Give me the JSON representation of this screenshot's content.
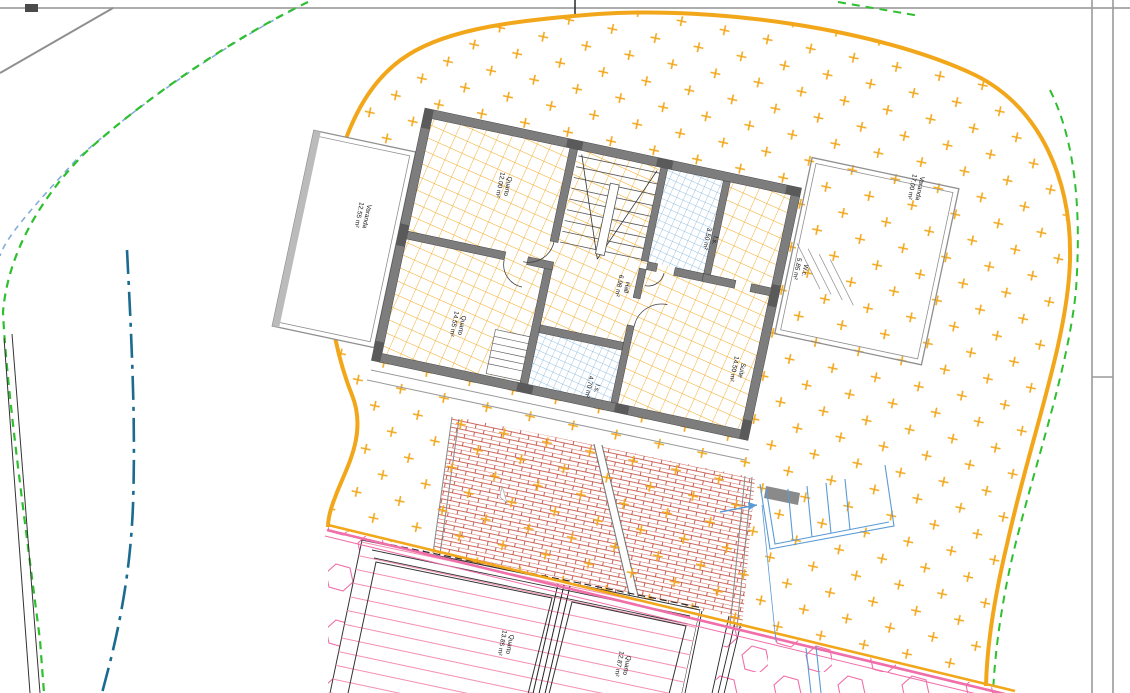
{
  "plan": {
    "type": "architectural-site-and-floor-plan",
    "labels": {
      "varanda_left": {
        "name": "Varanda",
        "area": "12.55 m²"
      },
      "quarto_top_left": {
        "name": "Quarto",
        "area": "12.00 m²"
      },
      "quarto_bottom_left": {
        "name": "Quarto",
        "area": "14.55 m²"
      },
      "hall": {
        "name": "Hall",
        "area": "6.98 m²"
      },
      "is_top": {
        "name": "I.s.",
        "area": "3.50 m²"
      },
      "wc": {
        "name": "W.c.",
        "area": "5.85 m²"
      },
      "suite": {
        "name": "Suíte",
        "area": "14.50 m²"
      },
      "is_bottom": {
        "name": "I.s.",
        "area": "4.70 m²"
      },
      "varanda_right": {
        "name": "Varanda",
        "area": "17.00 m²"
      },
      "quarto_lower_left": {
        "name": "Quarto",
        "area": "13.85 m²"
      },
      "quarto_lower_right": {
        "name": "Quarto",
        "area": "12.87 m²"
      }
    },
    "colors": {
      "lot_boundary": "#F2A71B",
      "terrain_hatch": "#F2A71B",
      "floor_tile": "#F2A71B",
      "bath_tile": "#74AEDC",
      "wall_fill": "#7D7D7D",
      "contour_green": "#2EBF2E",
      "contour_blue": "#85AEDA",
      "stream_teal": "#1A6B8F",
      "lower_zone_pink": "#F06EA9",
      "brick_red": "#C0392B",
      "stair_blue": "#5B9BD5",
      "sheet_gray": "#9A9A9A"
    }
  }
}
